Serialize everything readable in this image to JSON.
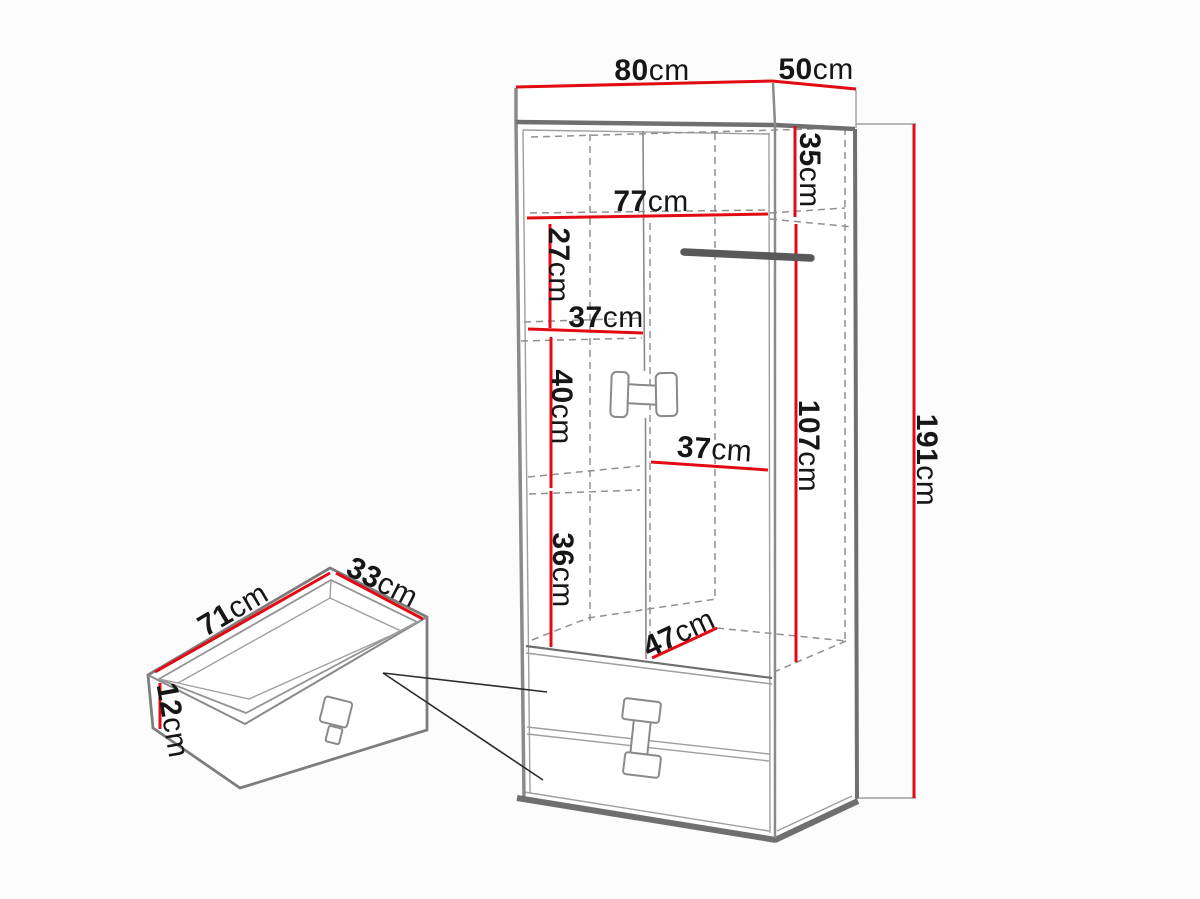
{
  "figure": {
    "type": "furniture-dimension-diagram",
    "unit": "cm"
  },
  "colors": {
    "dimension_line": "#e30b13",
    "edge": "#7d7d7d",
    "text": "#161616",
    "rail": "#595959",
    "background": "#fcfcfc"
  },
  "wardrobe": {
    "width": {
      "value": "80",
      "unit": "cm"
    },
    "depth": {
      "value": "50",
      "unit": "cm"
    },
    "height": {
      "value": "191",
      "unit": "cm"
    },
    "top_section_height": {
      "value": "35",
      "unit": "cm"
    },
    "interior_width": {
      "value": "77",
      "unit": "cm"
    },
    "upper_shelf_gap": {
      "value": "27",
      "unit": "cm"
    },
    "shelf_width": {
      "value": "37",
      "unit": "cm"
    },
    "middle_shelf_gap": {
      "value": "40",
      "unit": "cm"
    },
    "hanging_section_width": {
      "value": "37",
      "unit": "cm"
    },
    "lower_shelf_gap": {
      "value": "36",
      "unit": "cm"
    },
    "hanging_section_height": {
      "value": "107",
      "unit": "cm"
    },
    "bottom_section_depth": {
      "value": "47",
      "unit": "cm"
    }
  },
  "drawer": {
    "width": {
      "value": "71",
      "unit": "cm"
    },
    "depth": {
      "value": "33",
      "unit": "cm"
    },
    "front_height": {
      "value": "12",
      "unit": "cm"
    }
  }
}
